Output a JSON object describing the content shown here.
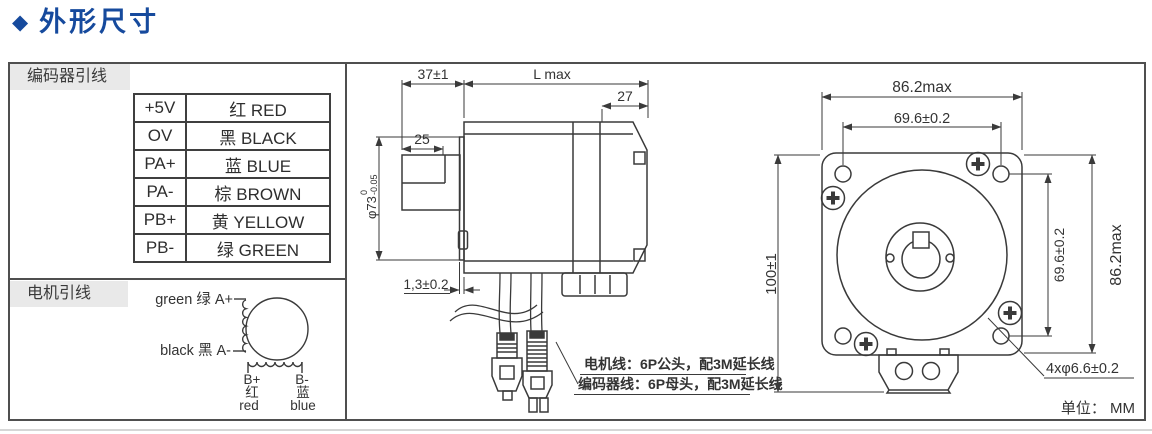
{
  "title": {
    "icon": "◆",
    "text": "外形尺寸"
  },
  "colors": {
    "title_blue": "#164a9d",
    "line_dark": "#3a3a3a",
    "section_label_bg": "#e9e9e9"
  },
  "left_panel": {
    "encoder_header": "编码器引线",
    "encoder_table": [
      {
        "pin": "+5V",
        "color": "红 RED"
      },
      {
        "pin": "OV",
        "color": "黑 BLACK"
      },
      {
        "pin": "PA+",
        "color": "蓝 BLUE"
      },
      {
        "pin": "PA-",
        "color": "棕 BROWN"
      },
      {
        "pin": "PB+",
        "color": "黄 YELLOW"
      },
      {
        "pin": "PB-",
        "color": "绿 GREEN"
      }
    ],
    "motor_header": "电机引线",
    "winding": {
      "a_plus": "green 绿 A+",
      "a_minus": "black 黑 A-",
      "b_plus": "B+",
      "b_plus_cn": "红",
      "b_plus_en": "red",
      "b_minus": "B-",
      "b_minus_cn": "蓝",
      "b_minus_en": "blue"
    }
  },
  "side_view": {
    "dims": {
      "shaft_len": "37±1",
      "body_len": "L  max",
      "rear_len": "27",
      "flat_len": "25",
      "pilot_dia": "φ73",
      "pilot_tol_up": "0",
      "pilot_tol_dn": "-0.05",
      "boss_thk": "1,3±0.2"
    },
    "callout_motor": "电机线：6P公头，配3M延长线",
    "callout_encoder": "编码器线：6P母头，配3M延长线"
  },
  "front_view": {
    "dims": {
      "width_max": "86.2max",
      "hole_pitch_h": "69.6±0.2",
      "height": "100±1",
      "hole_pitch_v": "69.6±0.2",
      "height_max": "86.2max",
      "hole_dia": "4xφ6.6±0.2"
    },
    "unit": "单位： MM"
  }
}
